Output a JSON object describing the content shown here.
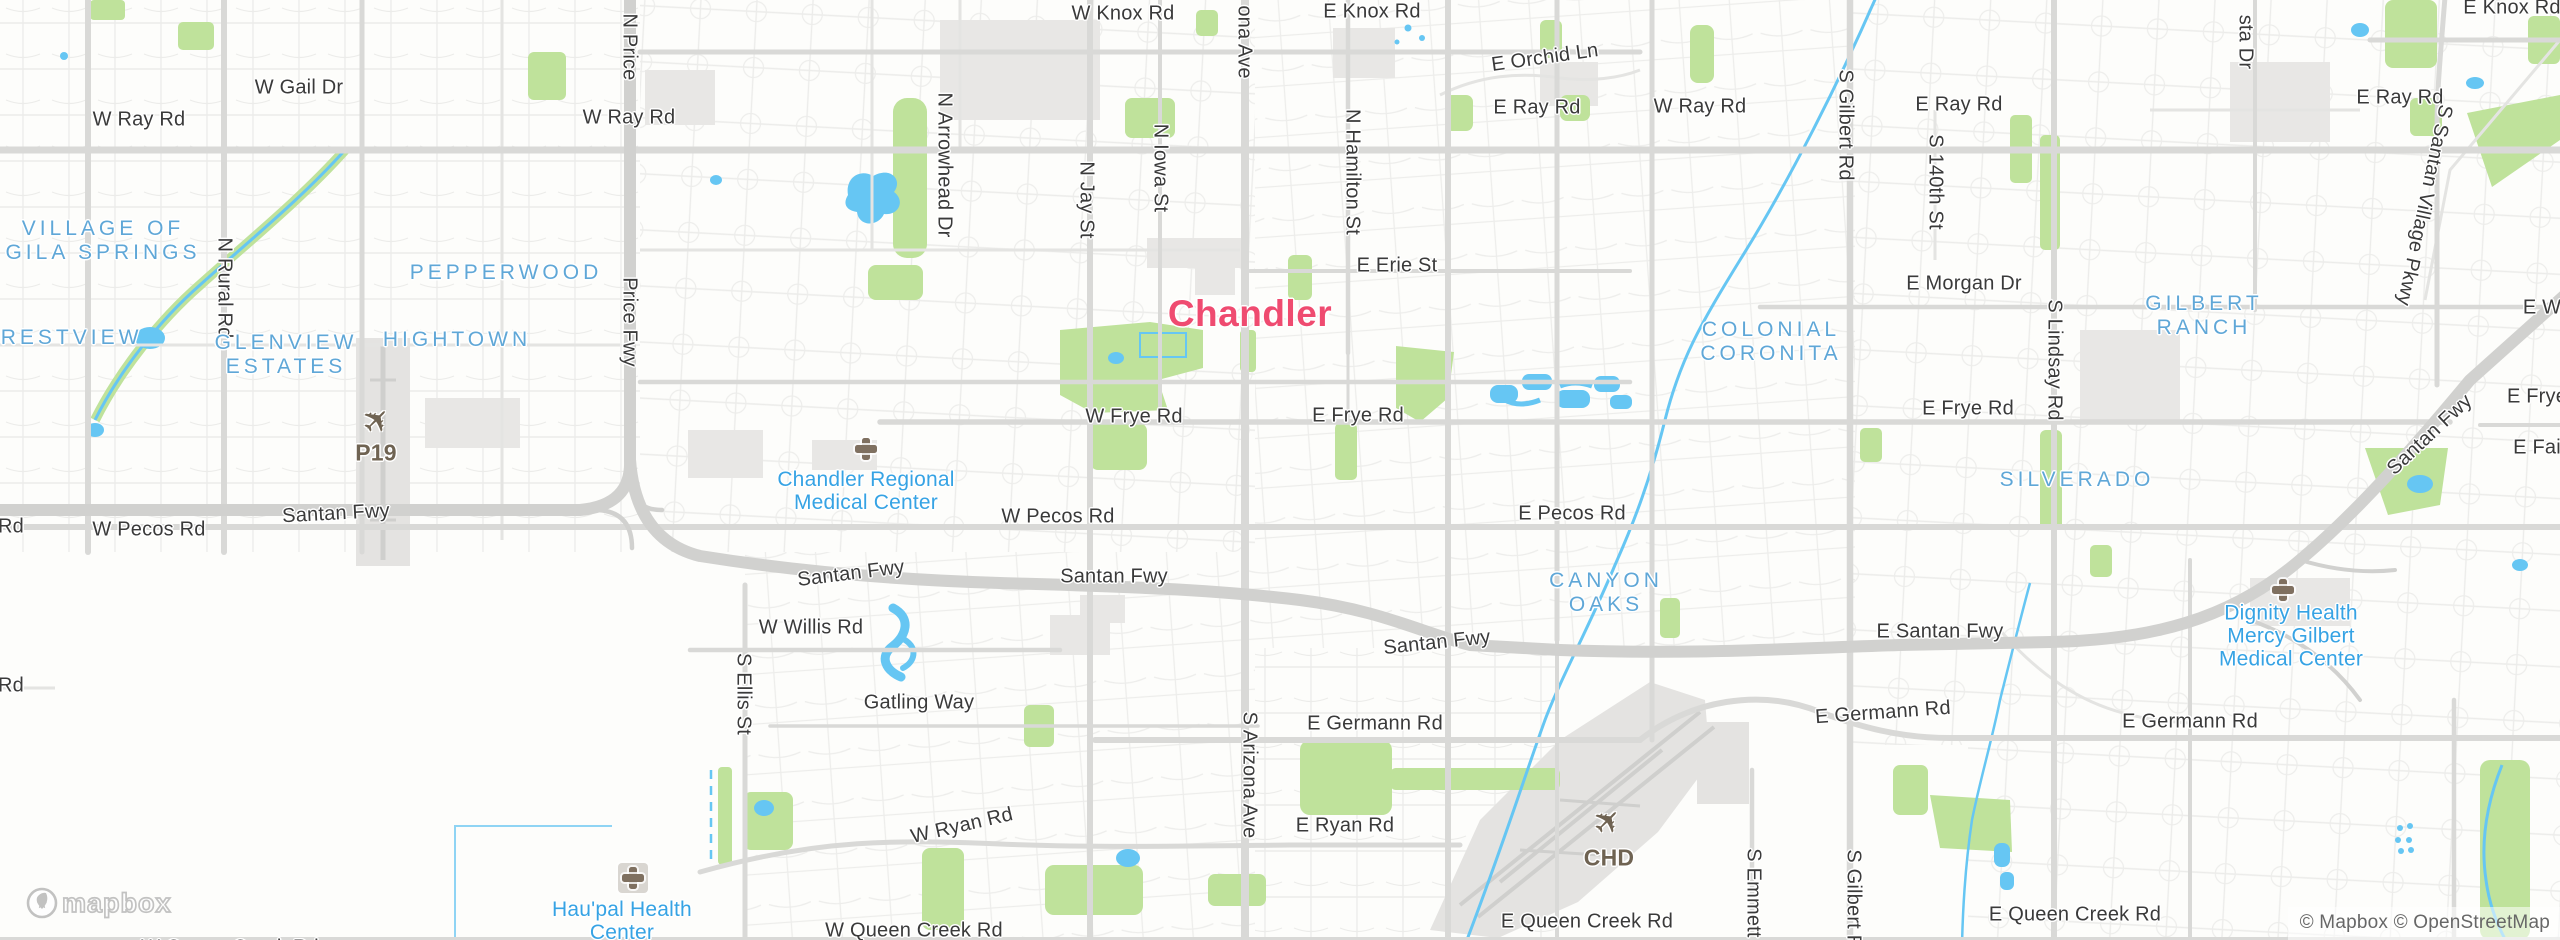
{
  "map": {
    "city_label": {
      "text": "Chandler",
      "x": 1250,
      "y": 314
    },
    "road_labels": [
      {
        "text": "W Knox Rd",
        "x": 1123,
        "y": 14
      },
      {
        "text": "E Knox Rd",
        "x": 1372,
        "y": 12
      },
      {
        "text": "E Knox Rd",
        "x": 2512,
        "y": 8
      },
      {
        "text": "E Orchid Ln",
        "x": 1545,
        "y": 58,
        "rot": -8
      },
      {
        "text": "W Ray Rd",
        "x": 139,
        "y": 120
      },
      {
        "text": "W Gail Dr",
        "x": 299,
        "y": 88
      },
      {
        "text": "W Ray Rd",
        "x": 629,
        "y": 118
      },
      {
        "text": "E Ray Rd",
        "x": 1537,
        "y": 108
      },
      {
        "text": "W Ray Rd",
        "x": 1700,
        "y": 107
      },
      {
        "text": "E Ray Rd",
        "x": 1959,
        "y": 105
      },
      {
        "text": "E Ray Rd",
        "x": 2400,
        "y": 98
      },
      {
        "text": "E Erie St",
        "x": 1397,
        "y": 266
      },
      {
        "text": "E Morgan Dr",
        "x": 1964,
        "y": 284
      },
      {
        "text": "E W",
        "x": 2542,
        "y": 308
      },
      {
        "text": "W Frye Rd",
        "x": 1134,
        "y": 417
      },
      {
        "text": "E Frye Rd",
        "x": 1358,
        "y": 416
      },
      {
        "text": "E Frye Rd",
        "x": 1968,
        "y": 409
      },
      {
        "text": "E Frye",
        "x": 2537,
        "y": 397
      },
      {
        "text": "E Fai",
        "x": 2537,
        "y": 448
      },
      {
        "text": "W Pecos Rd",
        "x": 149,
        "y": 530
      },
      {
        "text": "W Pecos Rd",
        "x": 1058,
        "y": 517
      },
      {
        "text": "E Pecos Rd",
        "x": 1572,
        "y": 514
      },
      {
        "text": "Santan Fwy",
        "x": 336,
        "y": 514,
        "rot": -3
      },
      {
        "text": "Santan Fwy",
        "x": 851,
        "y": 574,
        "rot": -7
      },
      {
        "text": "Santan Fwy",
        "x": 1114,
        "y": 577
      },
      {
        "text": "Santan Fwy",
        "x": 1437,
        "y": 643,
        "rot": -6
      },
      {
        "text": "E Santan Fwy",
        "x": 1940,
        "y": 632
      },
      {
        "text": "Santan Fwy",
        "x": 2430,
        "y": 435,
        "rot": -43
      },
      {
        "text": "W Willis Rd",
        "x": 811,
        "y": 628
      },
      {
        "text": "Gatling Way",
        "x": 919,
        "y": 703
      },
      {
        "text": "E Germann Rd",
        "x": 1375,
        "y": 724
      },
      {
        "text": "E Germann Rd",
        "x": 1883,
        "y": 713,
        "rot": -4
      },
      {
        "text": "E Germann Rd",
        "x": 2190,
        "y": 722
      },
      {
        "text": "W Ryan Rd",
        "x": 962,
        "y": 826,
        "rot": -13
      },
      {
        "text": "E Ryan Rd",
        "x": 1345,
        "y": 826
      },
      {
        "text": "W Queen Creek Rd",
        "x": 914,
        "y": 931
      },
      {
        "text": "E Queen Creek Rd",
        "x": 1587,
        "y": 922
      },
      {
        "text": "E Queen Creek Rd",
        "x": 2075,
        "y": 915
      },
      {
        "text": "W Queen Creek Rd",
        "x": 230,
        "y": 948
      },
      {
        "text": "Rd",
        "x": 11,
        "y": 527
      },
      {
        "text": "Rd",
        "x": 11,
        "y": 686
      }
    ],
    "vertical_road_labels": [
      {
        "text": "N Rural Rd",
        "x": 224,
        "y": 288
      },
      {
        "text": "N Price",
        "x": 629,
        "y": 47
      },
      {
        "text": "Price Fwy",
        "x": 629,
        "y": 322
      },
      {
        "text": "N Arrowhead Dr",
        "x": 944,
        "y": 165
      },
      {
        "text": "N Jay St",
        "x": 1086,
        "y": 200
      },
      {
        "text": "N Iowa St",
        "x": 1160,
        "y": 168
      },
      {
        "text": "ona Ave",
        "x": 1244,
        "y": 42
      },
      {
        "text": "N Hamilton St",
        "x": 1352,
        "y": 172
      },
      {
        "text": "S Gilbert Rd",
        "x": 1845,
        "y": 125
      },
      {
        "text": "S 140th St",
        "x": 1935,
        "y": 182
      },
      {
        "text": "sta Dr",
        "x": 2245,
        "y": 42
      },
      {
        "text": "S Lindsay Rd",
        "x": 2054,
        "y": 360
      },
      {
        "text": "S Santan Village Pkwy",
        "x": 2424,
        "y": 205,
        "rot": 12
      },
      {
        "text": "S Ellis St",
        "x": 743,
        "y": 694
      },
      {
        "text": "S Arizona Ave",
        "x": 1249,
        "y": 775
      },
      {
        "text": "S Emmett",
        "x": 1753,
        "y": 893
      },
      {
        "text": "S Gilbert Rd",
        "x": 1853,
        "y": 905
      }
    ],
    "area_labels": [
      {
        "lines": [
          "VILLAGE OF",
          "GILA SPRINGS"
        ],
        "x": 103,
        "y": 241
      },
      {
        "lines": [
          "CRESTVIEW"
        ],
        "x": 62,
        "y": 338
      },
      {
        "lines": [
          "GLENVIEW",
          "ESTATES"
        ],
        "x": 286,
        "y": 355
      },
      {
        "lines": [
          "HIGHTOWN"
        ],
        "x": 457,
        "y": 340
      },
      {
        "lines": [
          "PEPPERWOOD"
        ],
        "x": 506,
        "y": 273
      },
      {
        "lines": [
          "COLONIAL",
          "CORONITA"
        ],
        "x": 1771,
        "y": 342
      },
      {
        "lines": [
          "GILBERT",
          "RANCH"
        ],
        "x": 2204,
        "y": 316
      },
      {
        "lines": [
          "SILVERADO"
        ],
        "x": 2077,
        "y": 480
      },
      {
        "lines": [
          "CANYON",
          "OAKS"
        ],
        "x": 1606,
        "y": 593
      }
    ],
    "poi_labels": [
      {
        "lines": [
          "Chandler Regional",
          "Medical Center"
        ],
        "x": 866,
        "y": 491,
        "icon": "hospital-icon",
        "icon_x": 866,
        "icon_y": 449
      },
      {
        "lines": [
          "Hau'pal Health",
          "Center"
        ],
        "x": 622,
        "y": 921,
        "icon": "hospital-icon-boxed",
        "icon_x": 633,
        "icon_y": 878
      },
      {
        "lines": [
          "Dignity Health",
          "Mercy Gilbert",
          "Medical Center"
        ],
        "x": 2291,
        "y": 636,
        "icon": "hospital-icon",
        "icon_x": 2283,
        "icon_y": 590
      }
    ],
    "airport_labels": [
      {
        "code": "P19",
        "x": 376,
        "y": 453,
        "plane_x": 377,
        "plane_y": 421
      },
      {
        "code": "CHD",
        "x": 1609,
        "y": 858,
        "plane_x": 1608,
        "plane_y": 822
      }
    ]
  },
  "branding": {
    "logo_text": "mapbox"
  },
  "attribution": {
    "text": "© Mapbox © OpenStreetMap"
  },
  "colors": {
    "city": "#ef4b70",
    "area": "#5fa7d7",
    "poi": "#36a3e4",
    "road_text": "#3a3a3a",
    "airport_text": "#6f6352",
    "water": "#66c6f3",
    "park": "#bfe29b",
    "freeway": "#d1d1cf",
    "arterial": "#d9d9d7"
  }
}
